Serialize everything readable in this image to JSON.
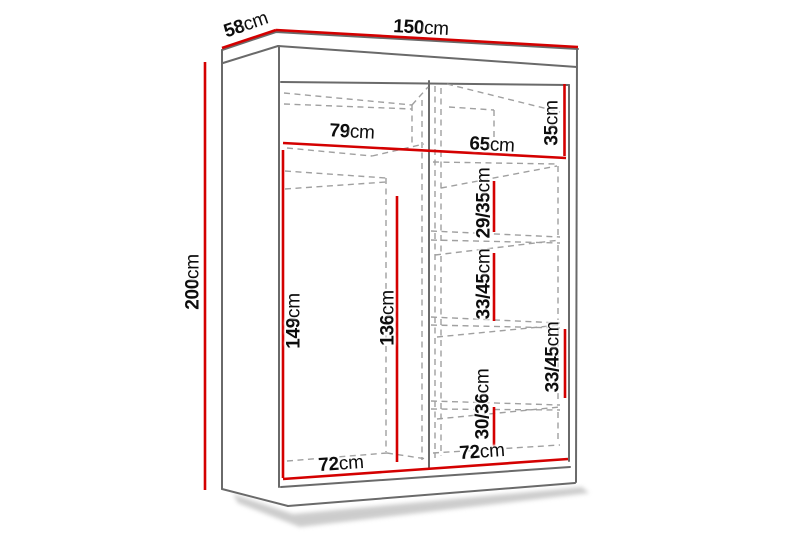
{
  "unit": "cm",
  "colors": {
    "dimension_line": "#d40000",
    "outline": "#6a6a6a",
    "hidden_line": "#a0a0a0",
    "background": "#ffffff",
    "label_text": "#0d0d0d"
  },
  "labels": {
    "width": {
      "value": "150",
      "unit": "cm"
    },
    "depth": {
      "value": "58",
      "unit": "cm"
    },
    "height": {
      "value": "200",
      "unit": "cm"
    },
    "left_section_width": {
      "value": "79",
      "unit": "cm"
    },
    "right_section_width": {
      "value": "65",
      "unit": "cm"
    },
    "top_shelf_height": {
      "value": "35",
      "unit": "cm"
    },
    "left_interior_height": {
      "value": "149",
      "unit": "cm"
    },
    "left_interior_back_height": {
      "value": "136",
      "unit": "cm"
    },
    "shelf_space_1": {
      "value": "29/35",
      "unit": "cm"
    },
    "shelf_space_2": {
      "value": "33/45",
      "unit": "cm"
    },
    "shelf_space_3": {
      "value": "33/45",
      "unit": "cm"
    },
    "shelf_space_4": {
      "value": "30/36",
      "unit": "cm"
    },
    "left_bottom_width": {
      "value": "72",
      "unit": "cm"
    },
    "right_bottom_width": {
      "value": "72",
      "unit": "cm"
    }
  }
}
